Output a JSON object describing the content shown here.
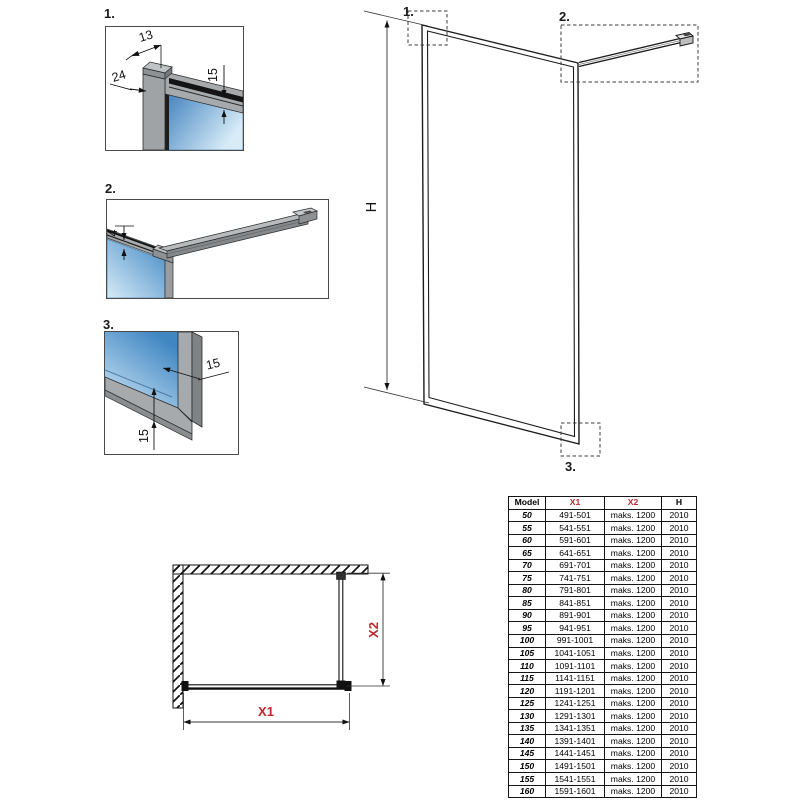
{
  "colors": {
    "accent_red": "#c1272d",
    "line": "#2b2b2b",
    "profile_gray": "#a6aaad",
    "glass_dark": "#4289c4",
    "glass_light": "#d6ebf8"
  },
  "details": [
    {
      "label": "1.",
      "dim_top": "13",
      "dim_left": "24",
      "dim_right": "15"
    },
    {
      "label": "2.",
      "dim_gap": "4"
    },
    {
      "label": "3.",
      "dim_side": "15",
      "dim_bottom": "15"
    }
  ],
  "elevation": {
    "callout_top_left": "1.",
    "callout_top_right": "2.",
    "callout_bottom_right": "3.",
    "height_label": "H"
  },
  "plan": {
    "width_label": "X1",
    "depth_label": "X2"
  },
  "table": {
    "headers": [
      "Model",
      "X1",
      "X2",
      "H"
    ],
    "rows": [
      [
        "50",
        "491-501",
        "maks. 1200",
        "2010"
      ],
      [
        "55",
        "541-551",
        "maks. 1200",
        "2010"
      ],
      [
        "60",
        "591-601",
        "maks. 1200",
        "2010"
      ],
      [
        "65",
        "641-651",
        "maks. 1200",
        "2010"
      ],
      [
        "70",
        "691-701",
        "maks. 1200",
        "2010"
      ],
      [
        "75",
        "741-751",
        "maks. 1200",
        "2010"
      ],
      [
        "80",
        "791-801",
        "maks. 1200",
        "2010"
      ],
      [
        "85",
        "841-851",
        "maks. 1200",
        "2010"
      ],
      [
        "90",
        "891-901",
        "maks. 1200",
        "2010"
      ],
      [
        "95",
        "941-951",
        "maks. 1200",
        "2010"
      ],
      [
        "100",
        "991-1001",
        "maks. 1200",
        "2010"
      ],
      [
        "105",
        "1041-1051",
        "maks. 1200",
        "2010"
      ],
      [
        "110",
        "1091-1101",
        "maks. 1200",
        "2010"
      ],
      [
        "115",
        "1141-1151",
        "maks. 1200",
        "2010"
      ],
      [
        "120",
        "1191-1201",
        "maks. 1200",
        "2010"
      ],
      [
        "125",
        "1241-1251",
        "maks. 1200",
        "2010"
      ],
      [
        "130",
        "1291-1301",
        "maks. 1200",
        "2010"
      ],
      [
        "135",
        "1341-1351",
        "maks. 1200",
        "2010"
      ],
      [
        "140",
        "1391-1401",
        "maks. 1200",
        "2010"
      ],
      [
        "145",
        "1441-1451",
        "maks. 1200",
        "2010"
      ],
      [
        "150",
        "1491-1501",
        "maks. 1200",
        "2010"
      ],
      [
        "155",
        "1541-1551",
        "maks. 1200",
        "2010"
      ],
      [
        "160",
        "1591-1601",
        "maks. 1200",
        "2010"
      ]
    ]
  }
}
